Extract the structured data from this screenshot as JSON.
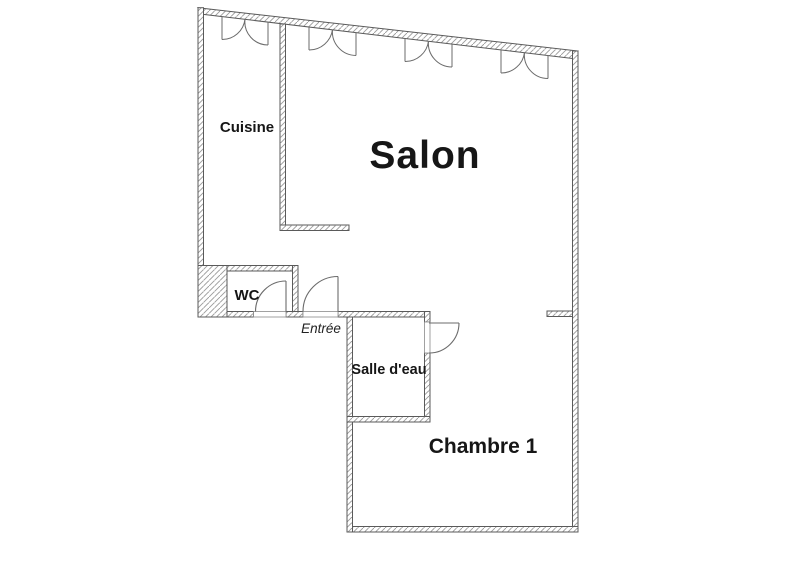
{
  "plan": {
    "type": "apartment-floor-plan",
    "rooms": {
      "cuisine": {
        "label": "Cuisine"
      },
      "salon": {
        "label": "Salon"
      },
      "wc": {
        "label": "WC"
      },
      "entree": {
        "label": "Entrée"
      },
      "salle_deau": {
        "label": "Salle d'eau"
      },
      "chambre1": {
        "label": "Chambre 1"
      }
    },
    "features": {
      "windows_count": "4",
      "doors_count": "3"
    },
    "colors": {
      "background": "#ffffff",
      "wall_outline": "#5a5a5a",
      "wall_hatch": "#9a9a9a",
      "door_symbol": "#6b6b6b",
      "label_text": "#161616"
    }
  }
}
